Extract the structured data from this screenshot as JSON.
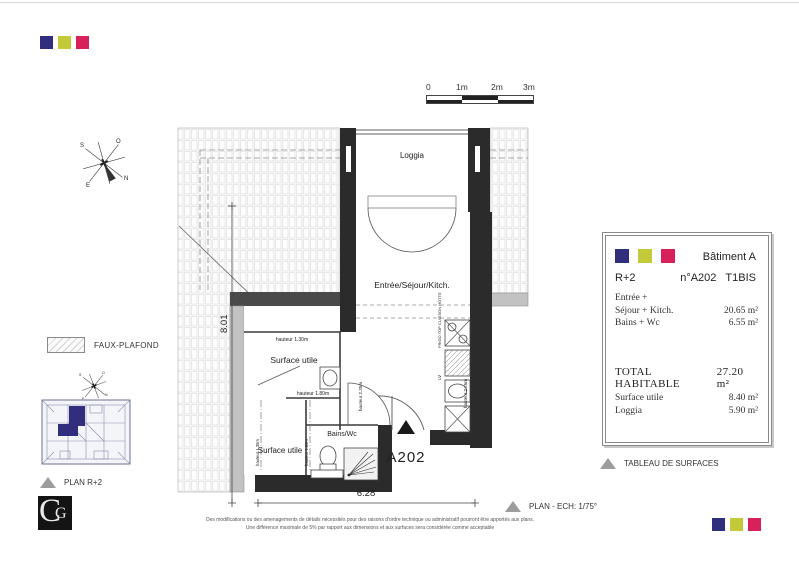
{
  "brand": {
    "navy": "#312e7e",
    "green": "#c3ca39",
    "pink": "#d8205a"
  },
  "scale_bar": {
    "labels": [
      "0",
      "1m",
      "2m",
      "3m"
    ]
  },
  "compass": {
    "n": "N",
    "s": "S",
    "e": "E",
    "o": "O"
  },
  "plan": {
    "rooms": {
      "loggia": "Loggia",
      "living": "Entrée/Séjour/Kitch.",
      "surface_utile_upper": "Surface utile",
      "surface_utile_lower": "Surface utile",
      "bains": "Bains/Wc"
    },
    "heights": {
      "left_wall": "hauteur 2.35m",
      "right_wall": "hauteur 2.25m",
      "h130": "hauteur 1.30m",
      "h180_top": "hauteur 1.80m",
      "h135": "hauteur 1.35m",
      "h180_side": "hauteur 1.80m"
    },
    "kitchen": {
      "frigo": "FRIGO TOP CUISSON HOTTE",
      "lv": "LV"
    },
    "dimensions": {
      "width": "6.28",
      "height": "8.01"
    },
    "unit_marker": "A202"
  },
  "legend": {
    "faux_plafond": "FAUX-PLAFOND",
    "key_plan": "PLAN R+2",
    "tableau": "TABLEAU DE SURFACES",
    "plan_ech": "PLAN - ECH: 1/75°"
  },
  "info_panel": {
    "building": "Bâtiment A",
    "floor": "R+2",
    "unit": "n°A202",
    "type": "T1BIS",
    "rows": [
      {
        "label": "Entrée +",
        "value": ""
      },
      {
        "label": "Séjour + Kitch.",
        "value": "20.65 m²"
      },
      {
        "label": "Bains + Wc",
        "value": "6.55 m²"
      }
    ],
    "total_label": "TOTAL HABITABLE",
    "total_value": "27.20 m²",
    "extra_rows": [
      {
        "label": "Surface utile",
        "value": "8.40 m²"
      },
      {
        "label": "Loggia",
        "value": "5.90 m²"
      }
    ]
  },
  "footer": {
    "line1": "Des modifications ou des amenagements de détails nécessités pour des raisons d'ordre technique ou administratif pourront être apportés aux plans.",
    "line2": "Une différence maximale de 5% par rapport aux dimensions et aux surfaces sera considérée comme acceptable"
  },
  "logo": {
    "c": "C",
    "g": "G"
  }
}
